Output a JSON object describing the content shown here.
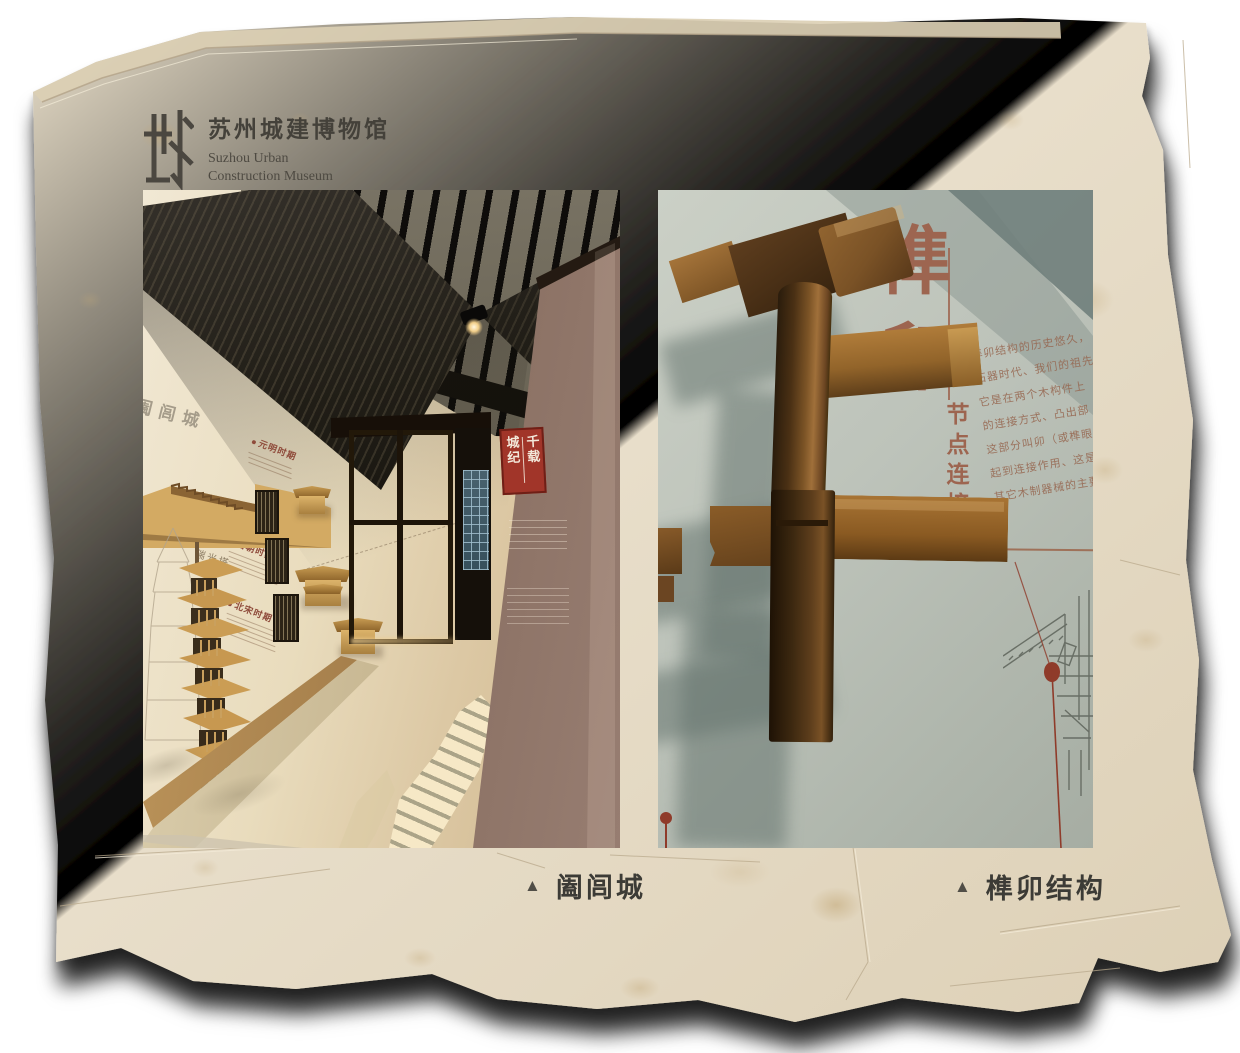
{
  "logo": {
    "mark_char": "城",
    "title_zh": "苏州城建博物馆",
    "title_en_line1": "Suzhou Urban",
    "title_en_line2": "Construction Museum"
  },
  "figures": {
    "left": {
      "marker": "▲",
      "caption": "阖闾城",
      "scene": {
        "wall_text": "阖闾城",
        "periods": [
          "元明时期",
          "唐朝时期",
          "北宋时期"
        ],
        "pagoda_label": "瑞光塔",
        "sign_col_right": "千载",
        "sign_col_left": "城纪"
      }
    },
    "right": {
      "marker": "▲",
      "caption": "榫卯结构",
      "scene": {
        "headline": "榫卯",
        "side_label": "节点连接",
        "body_lines": [
          "榫卯结构的历史悠久，",
          "石器时代、我们的祖先",
          "它是在两个木构件上",
          "的连接方式、凸出部",
          "这部分叫卯（或榫眼",
          "起到连接作用、这是",
          "其它木制器械的主要"
        ]
      }
    }
  },
  "colors": {
    "paper": "#e7dcc6",
    "sign_red": "#a13529",
    "headline_brown": "#9d6550",
    "caption_text": "#3c3b36",
    "wood_light": "#a87634",
    "wood_dark": "#3e2810"
  }
}
